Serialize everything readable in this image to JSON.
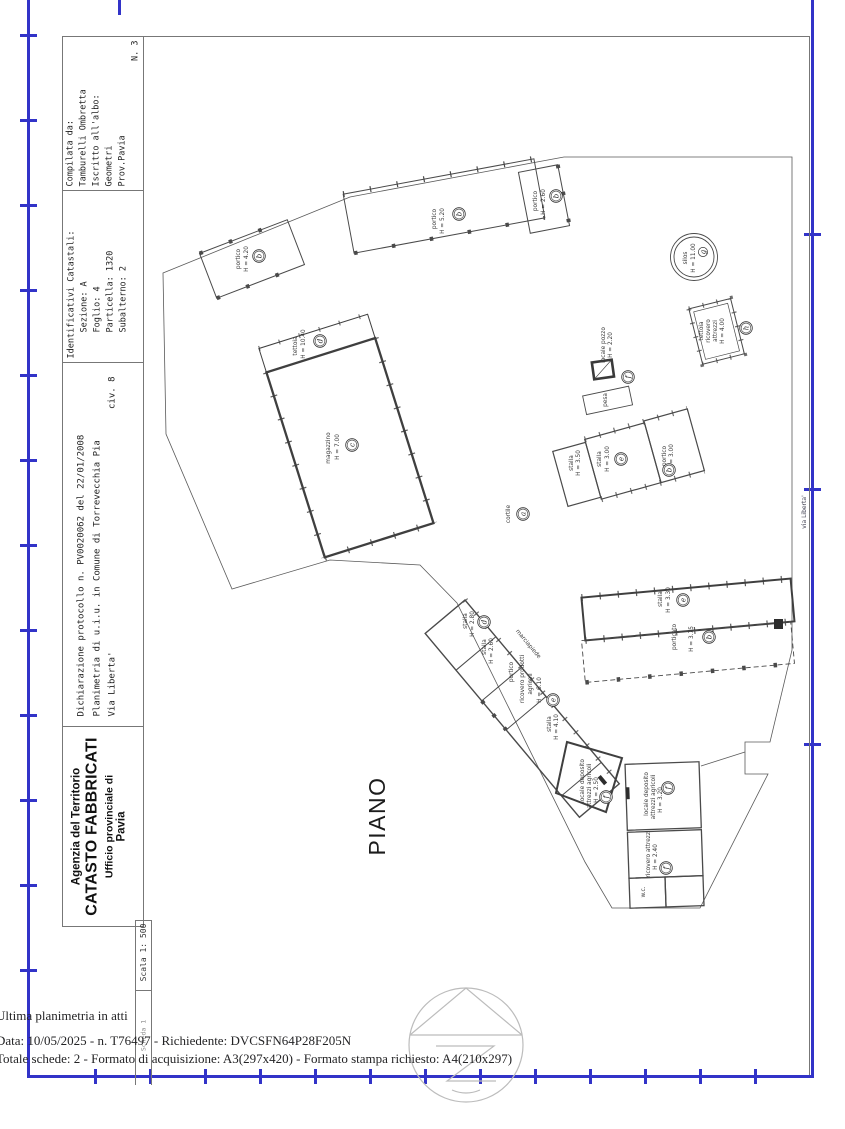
{
  "colors": {
    "frame_blue": "#3233c8",
    "drawing_line": "#4a4a4a"
  },
  "title_block": {
    "compiler": {
      "label": "Compilata da:",
      "name": "Tamburelli Ombretta",
      "register_label": "Iscritto all'albo:",
      "register": "Geometri",
      "province": "Prov.Pavia",
      "sheet_no": "N. 3"
    },
    "identifiers": {
      "title": "Identificativi Catastali:",
      "sezione": "Sezione: A",
      "foglio": "Foglio: 4",
      "particella": "Particella: 1320",
      "subalterno": "Subalterno: 2"
    },
    "declaration": {
      "protocol": "Dichiarazione protocollo n.  PV0020062 del  22/01/2008",
      "object": "Planimetria di u.i.u. in Comune di Torrevecchia Pia",
      "street": "Via Liberta'",
      "civic": "civ. 8"
    },
    "agency": {
      "line1": "Agenzia del Territorio",
      "line2": "CATASTO FABBRICATI",
      "line3": "Ufficio provinciale di",
      "line4": "Pavia"
    },
    "scale": "Scala 1: 500",
    "sheet_strip": "Scheda 1"
  },
  "plan": {
    "floor_label": "PIANO TERRA",
    "street_label": "via Liberta'",
    "rooms": [
      {
        "name": "portico",
        "height": "H = 4.20",
        "letter": "b"
      },
      {
        "name": "portico",
        "height": "H = 5.20",
        "letter": "b"
      },
      {
        "name": "portico",
        "height": "H = 2.60",
        "letter": "b"
      },
      {
        "name": "tettoia",
        "height": "H = 10.40",
        "letter": "d"
      },
      {
        "name": "magazzino",
        "height": "H = 7.00",
        "letter": "c"
      },
      {
        "name": "silos",
        "height": "H = 11.00",
        "letter": "g"
      },
      {
        "name": "tettoia",
        "line2": "ricovero",
        "line3": "attrezzi",
        "height": "H = 4.00",
        "letter": "h"
      },
      {
        "name": "locale pozzo",
        "height": "H = 2.20",
        "letter": "f"
      },
      {
        "name": "pesa"
      },
      {
        "name": "cortile",
        "letter": "a"
      },
      {
        "name": "stalla",
        "height": "H = 3.50"
      },
      {
        "name": "stalla",
        "height": "H = 3.00",
        "letter": "e"
      },
      {
        "name": "portico",
        "height": "H = 3.00",
        "letter": "b"
      },
      {
        "name": "stalla",
        "height": "H = 3.30",
        "letter": "e"
      },
      {
        "name": "porticato",
        "height": "H = 3.75",
        "letter": "b"
      },
      {
        "name": "stalla",
        "height": "H = 2.80",
        "letter": "d"
      },
      {
        "name": "stalla",
        "height": "H = 2.60"
      },
      {
        "name": "portico"
      },
      {
        "name": "ricovero prodotti",
        "line2": "agricoli",
        "height": "H = 6.10",
        "letter": "e"
      },
      {
        "name": "stalla",
        "height": "H = 4.10"
      },
      {
        "name": "marciapiede"
      },
      {
        "name": "locale deposito",
        "line2": "attrezzi agricoli",
        "height": "H = 2.50",
        "letter": "f"
      },
      {
        "name": "locale deposito",
        "line2": "attrezzi agricoli",
        "height": "H = 3.20",
        "letter": "f"
      },
      {
        "name": "ricovero attrezzi",
        "height": "H = 2.40",
        "letter": "f"
      },
      {
        "name": "w.c."
      }
    ]
  },
  "footer": {
    "line1": "Ultima planimetria in atti",
    "line2": "Data: 10/05/2025 - n. T76497 - Richiedente: DVCSFN64P28F205N",
    "line3": "Totale schede: 2 - Formato di acquisizione: A3(297x420)  - Formato stampa richiesto: A4(210x297)"
  }
}
